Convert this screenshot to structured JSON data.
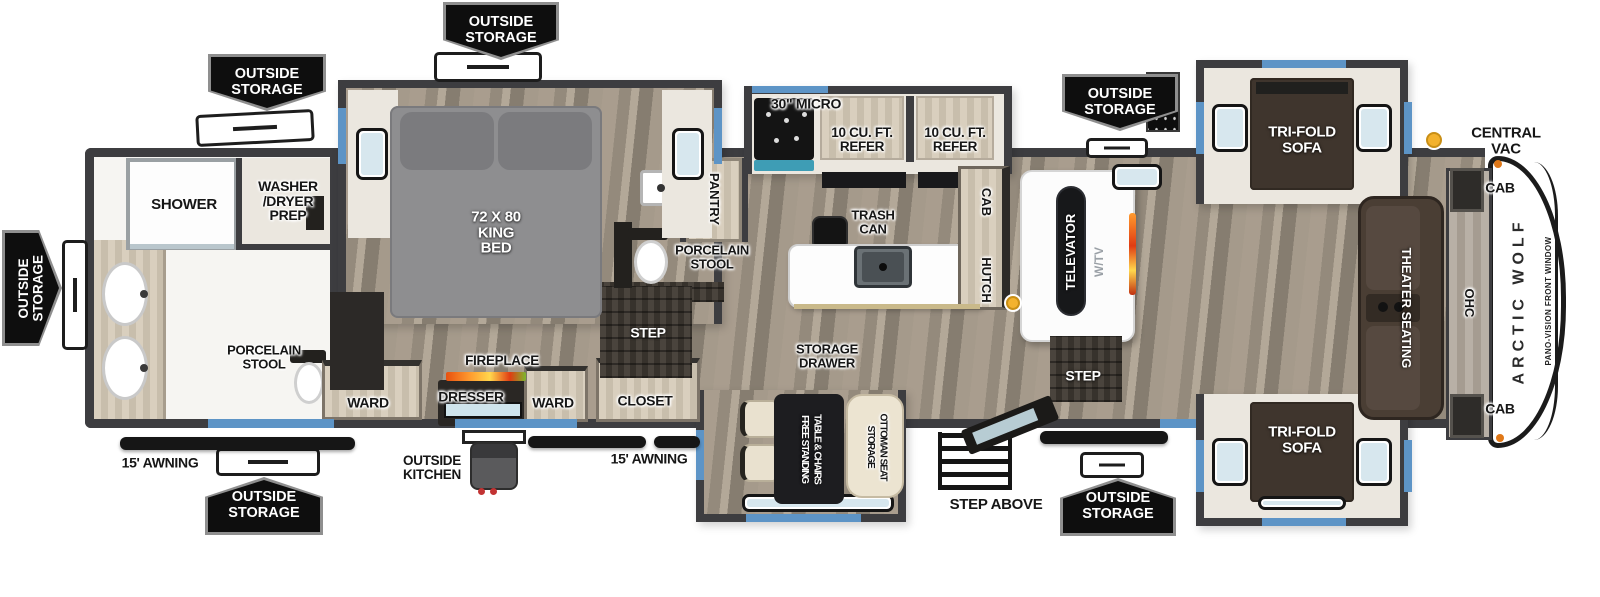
{
  "legend": {
    "central_vac": "CENTRAL VAC"
  },
  "exterior": {
    "outside_storage": "OUTSIDE\nSTORAGE",
    "awning": "15' AWNING",
    "outside_kitchen": "OUTSIDE\nKITCHEN",
    "step_above": "STEP ABOVE",
    "brand": "ARCTIC WOLF",
    "pano_vision": "PANO-VISION FRONT WINDOW"
  },
  "bath": {
    "shower": "SHOWER",
    "washer_dryer": "WASHER\n/DRYER\nPREP",
    "porcelain_stool": "PORCELAIN\nSTOOL",
    "pantry": "PANTRY"
  },
  "bedroom": {
    "king_bed": "72 X 80\nKING\nBED",
    "step": "STEP",
    "ward": "WARD",
    "closet": "CLOSET",
    "dresser": "DRESSER",
    "fireplace": "FIREPLACE"
  },
  "kitchen": {
    "micro": "30\" MICRO",
    "refer": "10 CU. FT.\nREFER",
    "trash_can": "TRASH\nCAN",
    "storage_drawer": "STORAGE\nDRAWER",
    "free_standing_table": "FREE STANDING\nTABLE & CHAIRS",
    "storage_ottoman": "STORAGE\nOTTOMAN SEAT"
  },
  "living": {
    "televator": "TELEVATOR",
    "wtv": "W/TV",
    "cab": "CAB",
    "hutch": "HUTCH",
    "tri_fold_sofa": "TRI-FOLD\nSOFA",
    "theater_seating": "THEATER SEATING",
    "ohc": "OHC",
    "step": "STEP"
  },
  "colors": {
    "wall": "#3d3d40",
    "accent_blue": "#5d94c6",
    "banner_bg": "#0e0e0e",
    "central_vac_dot": "#f3b22e",
    "sofa_brown": "#3f352d",
    "floor_wood": "#9c9083"
  }
}
